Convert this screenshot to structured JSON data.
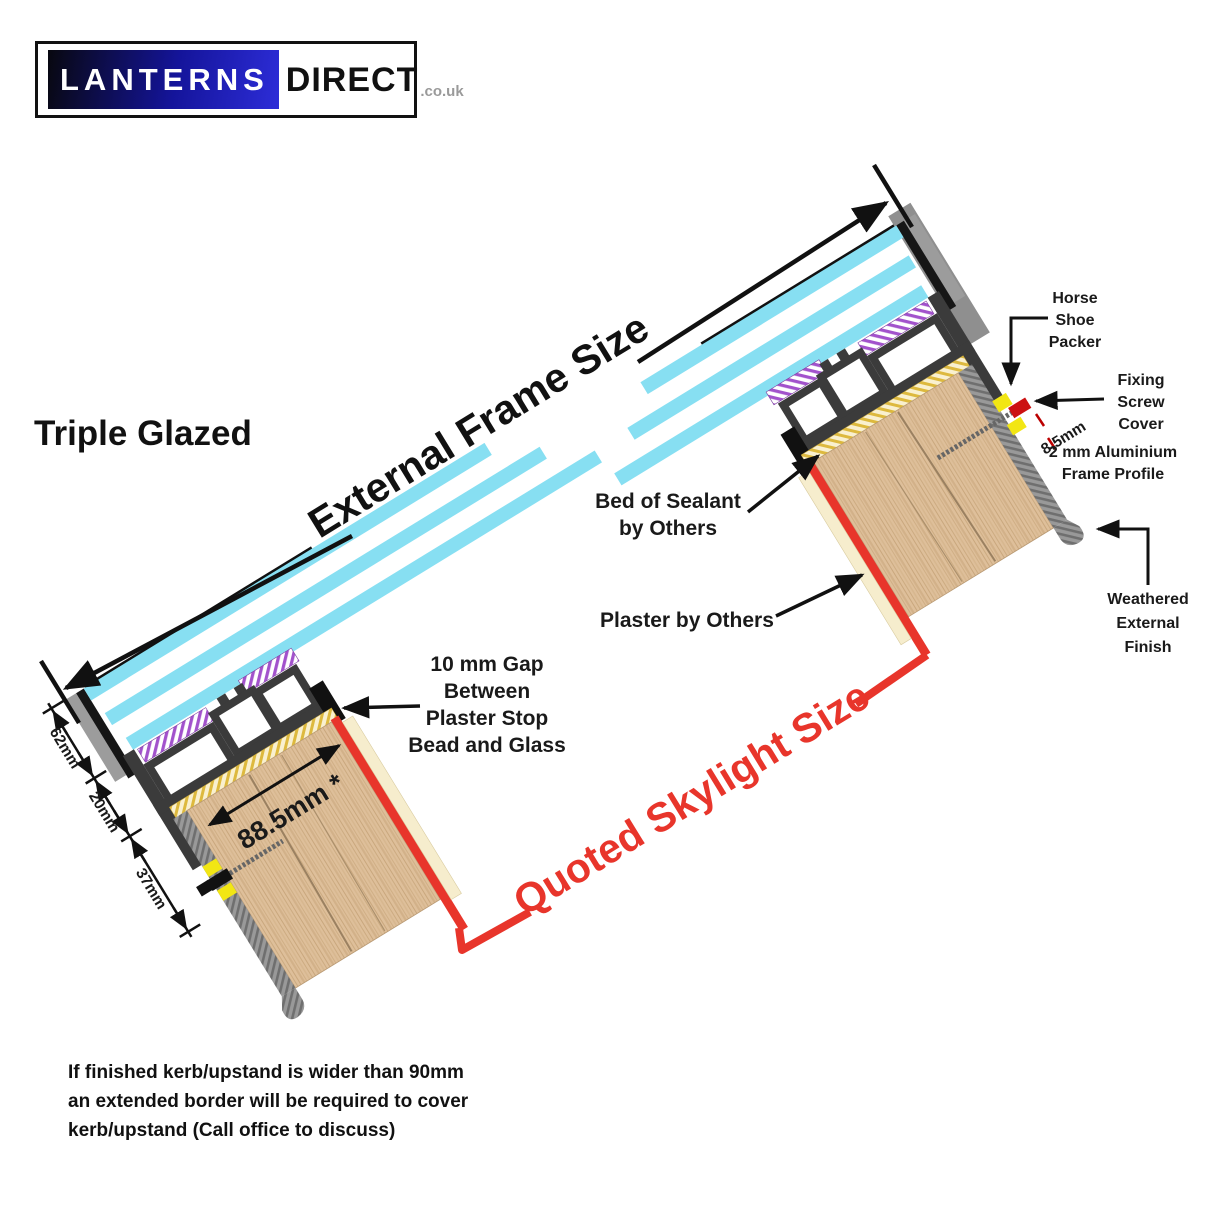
{
  "logo": {
    "brand_left": "LANTERNS",
    "brand_right": "DIRECT",
    "suffix": ".co.uk"
  },
  "title": "Triple Glazed",
  "labels": {
    "external_frame": "External Frame Size",
    "quoted_skylight": "Quoted Skylight Size"
  },
  "annotations": {
    "horse_shoe": [
      "Horse",
      "Shoe",
      "Packer"
    ],
    "fixing_screw": [
      "Fixing",
      "Screw",
      "Cover"
    ],
    "frame_profile": [
      "2 mm Aluminium",
      "Frame Profile"
    ],
    "weathered": [
      "Weathered",
      "External",
      "Finish"
    ],
    "sealant": [
      "Bed of Sealant",
      "by Others"
    ],
    "plaster": "Plaster by Others",
    "gap": [
      "10 mm Gap",
      "Between",
      "Plaster Stop",
      "Bead and Glass"
    ]
  },
  "dimensions": {
    "glazing": "62mm",
    "frame": "20mm",
    "kerb_depth": "37mm",
    "kerb_width": "88.5mm *",
    "edge": "8.5mm"
  },
  "footer": [
    "If finished kerb/upstand is wider than 90mm",
    "an extended border will be required to cover",
    "kerb/upstand (Call office to discuss)"
  ],
  "colors": {
    "accent_red": "#e8352b",
    "glass_cyan": "#87dff2",
    "wood": "#debf9a",
    "frame_dark": "#3b3b3b",
    "gasket_purple": "#a252cc",
    "sealant_yellow": "#ddb93e",
    "weathered_gray": "#9a9a9a"
  }
}
